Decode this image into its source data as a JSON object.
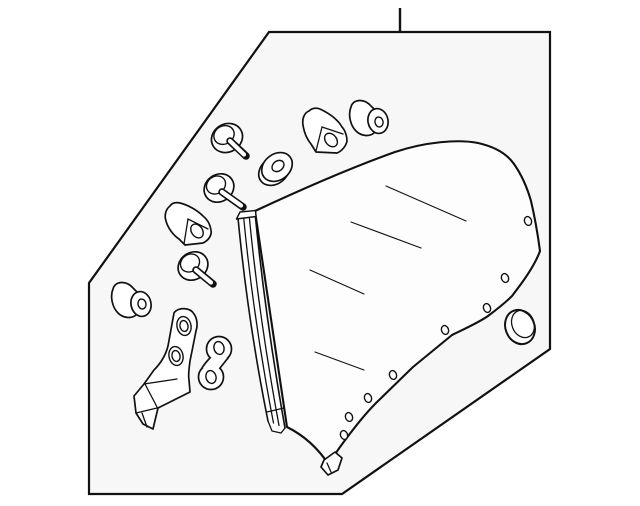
{
  "diagram": {
    "kind": "exploded-parts-line-drawing",
    "colors": {
      "line": "#111111",
      "panel_fill": "#f7f7f7",
      "part_fill": "#ffffff",
      "glass_fill": "#fdfdfd",
      "canvas": "#ffffff"
    },
    "glass_features": {
      "edge_hole_count": 8,
      "reflection_line_count": 4
    },
    "parts": [
      {
        "label": "quarter glass panel"
      },
      {
        "label": "glass run channel strip"
      },
      {
        "label": "screw with washer (upper)"
      },
      {
        "label": "screw with washer (middle)"
      },
      {
        "label": "screw with washer (lower)"
      },
      {
        "label": "washer grommet"
      },
      {
        "label": "retainer clip (right)"
      },
      {
        "label": "retainer clip (left)"
      },
      {
        "label": "cylindrical bushing (upper)"
      },
      {
        "label": "cylindrical bushing (lower)"
      },
      {
        "label": "mounting bracket with holes"
      },
      {
        "label": "link plate with two holes"
      },
      {
        "label": "oval body plug"
      },
      {
        "label": "callout leader line"
      },
      {
        "label": "diagram boundary panel"
      },
      {
        "label": "glass bottom tab"
      }
    ]
  }
}
